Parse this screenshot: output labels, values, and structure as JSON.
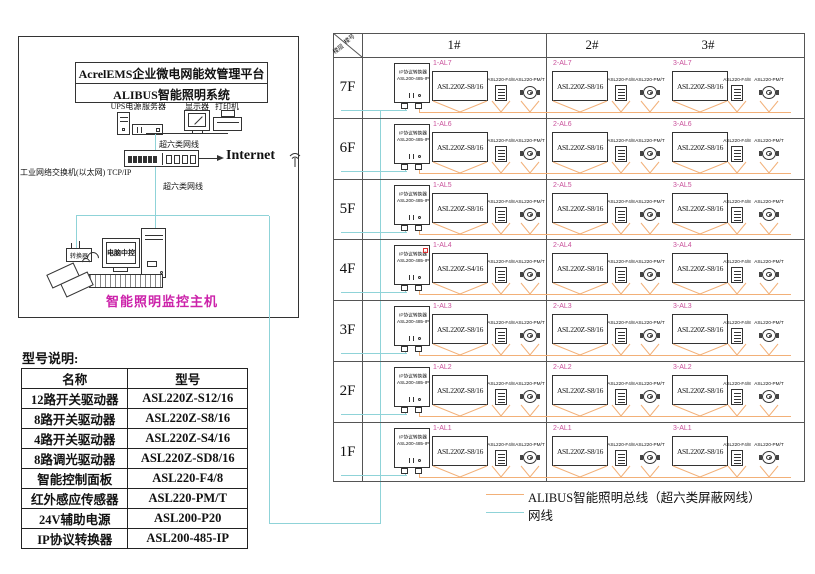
{
  "colors": {
    "bus": "#f2b078",
    "net": "#8fd3d8",
    "al_label": "#c9519b",
    "host_label": "#cc22aa",
    "flag": "#e03030",
    "grid_line": "#555"
  },
  "platform_box": {
    "title_line1": "AcrelEMS企业微电网能效管理平台",
    "title_line2": "ALIBUS智能照明系统",
    "device_labels": [
      "UPS电源",
      "服务器",
      "显示器",
      "打印机"
    ],
    "cable_label_top": "超六类网线",
    "cable_label_bottom": "超六类网线",
    "switch_caption": "工业网络交换机(以太网) TCP/IP",
    "internet_label": "Internet",
    "pc_screen_label": "电脑中控",
    "converter_label": "转换器",
    "host_label": "智能照明监控主机"
  },
  "model_table": {
    "title": "型号说明:",
    "headers": [
      "名称",
      "型号"
    ],
    "rows": [
      [
        "12路开关驱动器",
        "ASL220Z-S12/16"
      ],
      [
        "8路开关驱动器",
        "ASL220Z-S8/16"
      ],
      [
        "4路开关驱动器",
        "ASL220Z-S4/16"
      ],
      [
        "8路调光驱动器",
        "ASL220Z-SD8/16"
      ],
      [
        "智能控制面板",
        "ASL220-F4/8"
      ],
      [
        "红外感应传感器",
        "ASL220-PM/T"
      ],
      [
        "24V辅助电源",
        "ASL200-P20"
      ],
      [
        "IP协议转换器",
        "ASL200-485-IP"
      ]
    ]
  },
  "grid": {
    "corner_top": "楼号",
    "corner_bottom": "楼层",
    "columns": [
      "1#",
      "2#",
      "3#"
    ],
    "converter_line1": "IP协议转换器",
    "converter_line2": "ASL200-485-IP",
    "panel_model": "ASL220-F4/8",
    "sensor_model": "ASL220-PM/T",
    "rows": [
      {
        "floor": "7F",
        "marked": false,
        "segments": [
          {
            "label": "1-AL7",
            "model": "ASL220Z-S8/16"
          },
          {
            "label": "2-AL7",
            "model": "ASL220Z-S8/16"
          },
          {
            "label": "3-AL7",
            "model": "ASL220Z-S8/16"
          }
        ]
      },
      {
        "floor": "6F",
        "marked": false,
        "segments": [
          {
            "label": "1-AL6",
            "model": "ASL220Z-S8/16"
          },
          {
            "label": "2-AL6",
            "model": "ASL220Z-S8/16"
          },
          {
            "label": "3-AL6",
            "model": "ASL220Z-S8/16"
          }
        ]
      },
      {
        "floor": "5F",
        "marked": false,
        "segments": [
          {
            "label": "1-AL5",
            "model": "ASL220Z-S8/16"
          },
          {
            "label": "2-AL5",
            "model": "ASL220Z-S8/16"
          },
          {
            "label": "3-AL5",
            "model": "ASL220Z-S8/16"
          }
        ]
      },
      {
        "floor": "4F",
        "marked": true,
        "segments": [
          {
            "label": "1-AL4",
            "model": "ASL220Z-S4/16"
          },
          {
            "label": "2-AL4",
            "model": "ASL220Z-S8/16"
          },
          {
            "label": "3-AL4",
            "model": "ASL220Z-S8/16"
          }
        ]
      },
      {
        "floor": "3F",
        "marked": false,
        "segments": [
          {
            "label": "1-AL3",
            "model": "ASL220Z-S8/16"
          },
          {
            "label": "2-AL3",
            "model": "ASL220Z-S8/16"
          },
          {
            "label": "3-AL3",
            "model": "ASL220Z-S8/16"
          }
        ]
      },
      {
        "floor": "2F",
        "marked": false,
        "segments": [
          {
            "label": "1-AL2",
            "model": "ASL220Z-S8/16"
          },
          {
            "label": "2-AL2",
            "model": "ASL220Z-S8/16"
          },
          {
            "label": "3-AL2",
            "model": "ASL220Z-S8/16"
          }
        ]
      },
      {
        "floor": "1F",
        "marked": false,
        "segments": [
          {
            "label": "1-AL1",
            "model": "ASL220Z-S8/16"
          },
          {
            "label": "2-AL1",
            "model": "ASL220Z-S8/16"
          },
          {
            "label": "3-AL1",
            "model": "ASL220Z-S8/16"
          }
        ]
      }
    ]
  },
  "legend": {
    "bus_label": "ALIBUS智能照明总线（超六类屏蔽网线）",
    "net_label": "网线"
  }
}
